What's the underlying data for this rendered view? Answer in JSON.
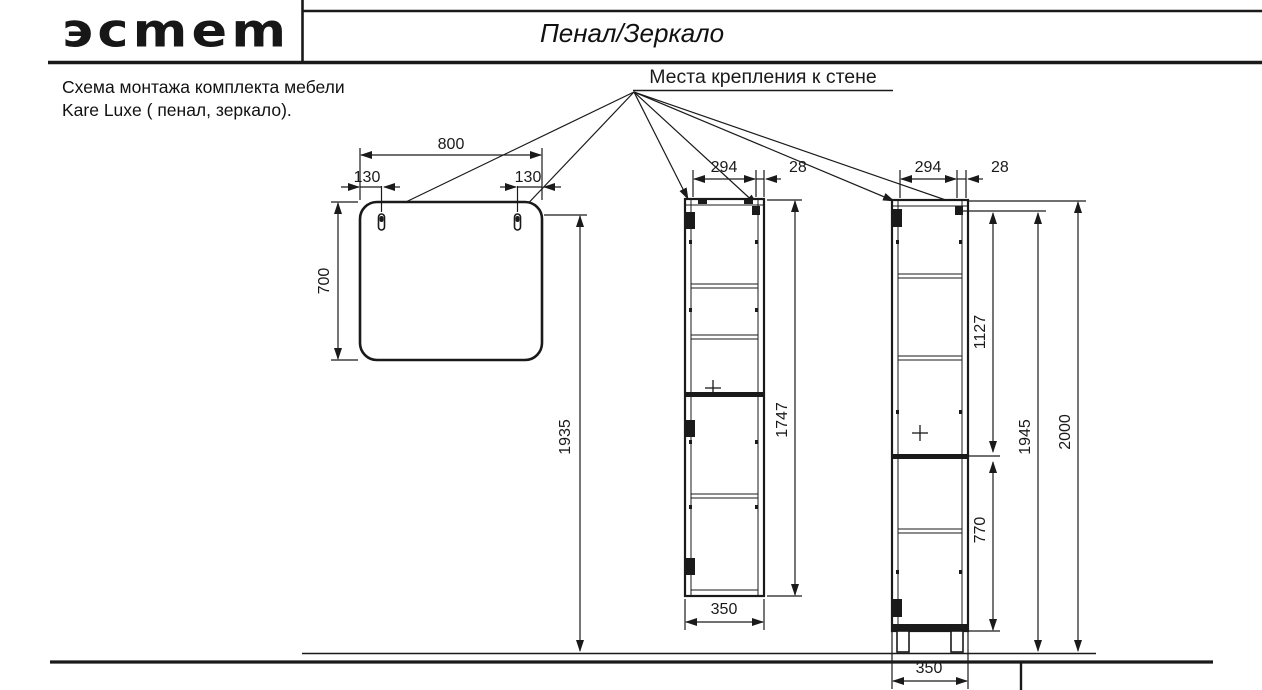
{
  "header": {
    "logo": "эсmеm",
    "title": "Пенал/Зеркало"
  },
  "note": {
    "line1": "Схема монтажа комплекта мебели",
    "line2": "Kare Luxe ( пенал, зеркало)."
  },
  "callout": {
    "label": "Места крепления к стене"
  },
  "colors": {
    "ink": "#1a1a1a",
    "background": "#ffffff"
  },
  "diagram": {
    "mirror": {
      "width": "800",
      "hole_offset_left": "130",
      "hole_offset_right": "130",
      "height": "700",
      "mount_height": "1935"
    },
    "cabinet_front": {
      "door_width": "294",
      "panel": "28",
      "carcass_height": "1747",
      "bottom_width": "350"
    },
    "cabinet_side": {
      "door_width": "294",
      "panel": "28",
      "upper_span": "1127",
      "lower_span": "770",
      "mount_height": "1945",
      "total_height": "2000",
      "base_width": "350"
    }
  }
}
